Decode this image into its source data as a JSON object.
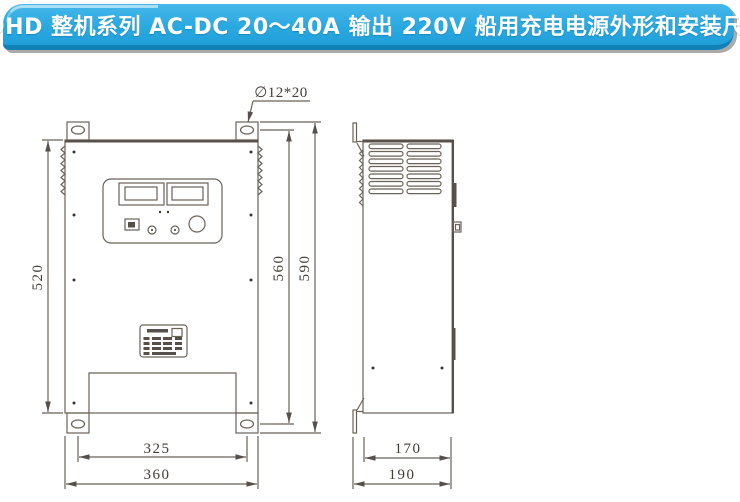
{
  "title": {
    "text": "CDHD 整机系列 AC-DC 20～40A 输出 220V 船用充电电源外形和安装尺寸"
  },
  "drawing": {
    "hole_callout": "∅12*20",
    "front_view": {
      "height_body": "520",
      "height_hole_spacing": "560",
      "height_overall": "590",
      "width_hole_spacing": "325",
      "width_overall": "360"
    },
    "side_view": {
      "depth_body": "170",
      "depth_overall": "190"
    }
  },
  "colors": {
    "banner_blue": "#2aa9e1",
    "banner_dark_edge": "#1180b5",
    "banner_shadow_gray": "#aaaaaa",
    "line_color": "#6b6259"
  }
}
